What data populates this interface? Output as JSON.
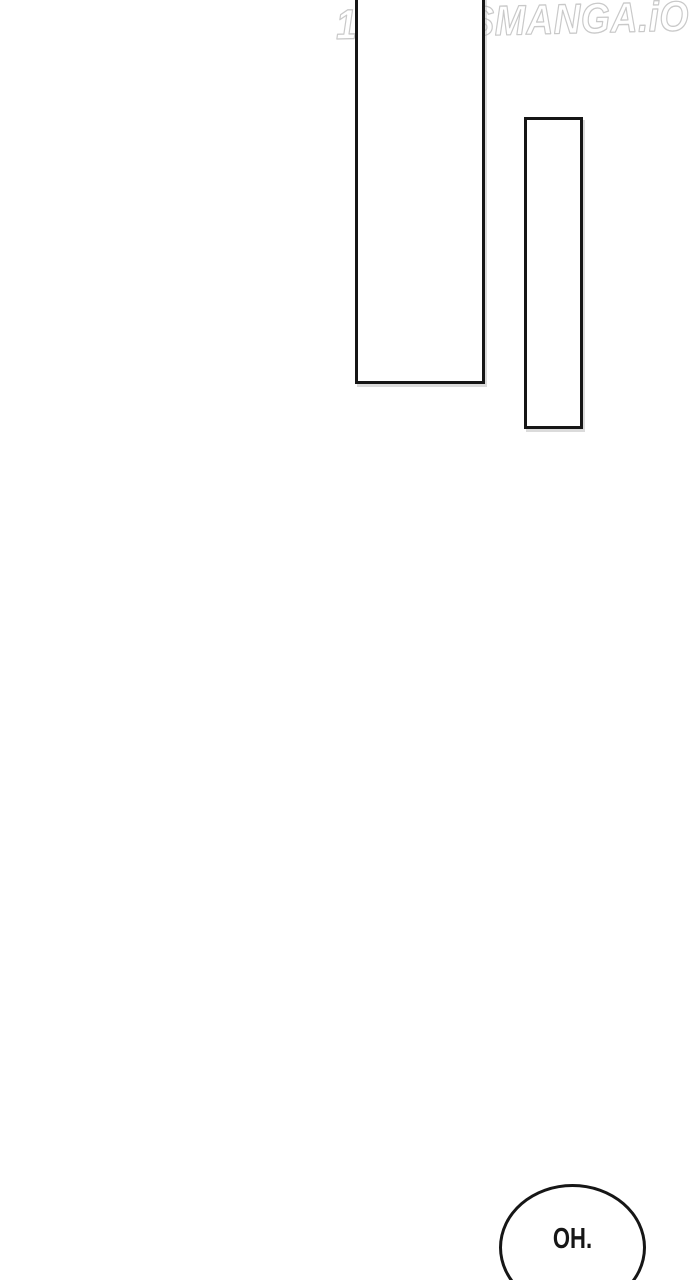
{
  "page": {
    "background_color": "#ffffff",
    "ink_color": "#161616"
  },
  "watermark": {
    "text": "1STKISSMANGA.iO",
    "color": "#c9c9c9"
  },
  "panels": [
    {
      "name": "tall-panel-frame",
      "content": ""
    },
    {
      "name": "narrow-panel-frame",
      "content": ""
    }
  ],
  "speech_bubble": {
    "text": "OH.",
    "text_color": "#161616",
    "border_color": "#161616",
    "fill_color": "#ffffff"
  }
}
